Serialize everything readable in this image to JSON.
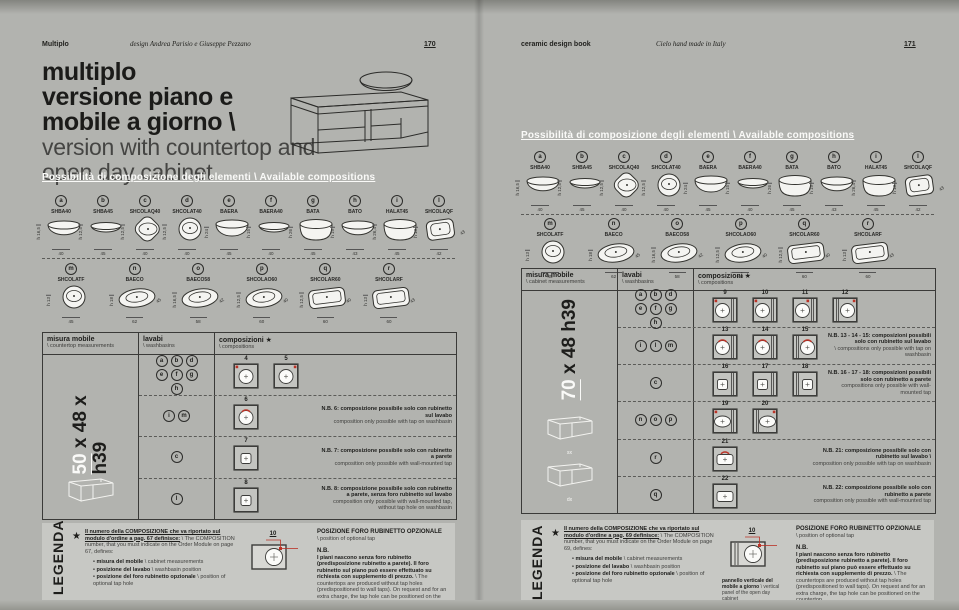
{
  "colors": {
    "page_bg": "#b2b3af",
    "legend_bg": "#c7c8c4",
    "ink": "#1d1d1b",
    "white": "#fafaf8",
    "red": "#bb3327",
    "tile_bg": "#c3c4c0"
  },
  "washbasins": {
    "row1": [
      {
        "letter": "a",
        "code": "SHBA40",
        "shape": "bowl",
        "h": "h 16,5",
        "w": "40"
      },
      {
        "letter": "b",
        "code": "SHBA45",
        "shape": "bowlflat",
        "h": "h 12,5",
        "w": "45"
      },
      {
        "letter": "c",
        "code": "SHCOLAQ40",
        "shape": "diamond",
        "h": "h 12,5",
        "w": "40"
      },
      {
        "letter": "d",
        "code": "SHCOLAT40",
        "shape": "round",
        "h": "h 12,5",
        "w": "40"
      },
      {
        "letter": "e",
        "code": "BAERA",
        "shape": "bowltall",
        "h": "h 24",
        "w": "45"
      },
      {
        "letter": "f",
        "code": "BAERA40",
        "shape": "bowlflat",
        "h": "h 15",
        "w": "40"
      },
      {
        "letter": "g",
        "code": "BATA",
        "shape": "cyl",
        "h": "h 26",
        "w": "45"
      },
      {
        "letter": "h",
        "code": "BATO",
        "shape": "bowl",
        "h": "h 19",
        "w": "43"
      },
      {
        "letter": "i",
        "code": "HALAT45",
        "shape": "cyl",
        "h": "h 26,4",
        "w": "45"
      },
      {
        "letter": "l",
        "code": "SHCOLAQF",
        "shape": "squareiso",
        "h": "h 13",
        "w": "42",
        "d": "43"
      }
    ],
    "row2": [
      {
        "letter": "m",
        "code": "SHCOLATF",
        "shape": "round",
        "h": "h 13",
        "w": "45"
      },
      {
        "letter": "n",
        "code": "BAECO",
        "shape": "ovaliso",
        "h": "h 18",
        "w": "62",
        "d": "45"
      },
      {
        "letter": "o",
        "code": "BAECO58",
        "shape": "ovaliso",
        "h": "h 16,5",
        "w": "58",
        "d": "42"
      },
      {
        "letter": "p",
        "code": "SHCOLAO60",
        "shape": "ovaliso",
        "h": "h 12,5",
        "w": "60",
        "d": "40"
      },
      {
        "letter": "q",
        "code": "SHCOLAR60",
        "shape": "rectiso",
        "h": "h 12,5",
        "w": "60",
        "d": "40"
      },
      {
        "letter": "r",
        "code": "SHCOLARF",
        "shape": "rectiso",
        "h": "h 13",
        "w": "60",
        "d": "43"
      }
    ]
  },
  "pages": {
    "left": {
      "header": {
        "brand": "Multiplo",
        "credit": "design Andrea Parisio e Giuseppe Pezzano",
        "page": "170"
      },
      "title_lines": [
        "multiplo",
        "versione piano e",
        "mobile a giorno \\"
      ],
      "subtitle_lines": [
        "version with countertop and",
        "open day cabinet"
      ],
      "section_heading": "Possibilità di composizione degli elementi \\ Available compositions",
      "table": {
        "h1_it": "misura mobile",
        "h1_en": "\\ countertop measurements",
        "h2_it": "lavabi",
        "h2_en": "\\ washbasins",
        "h3_it": "composizioni ★",
        "h3_en": "\\ compositions",
        "size_hi": "50",
        "size_rest": " x 48 x h39",
        "icon_labels": [
          ""
        ],
        "rows": [
          {
            "letters": [
              [
                "a",
                "b",
                "d"
              ],
              [
                "e",
                "f",
                "g"
              ],
              [
                "h"
              ]
            ],
            "comps": [
              {
                "n": "4",
                "basin": "circle",
                "mark": "tl"
              },
              {
                "n": "5",
                "basin": "circle",
                "mark": "tr"
              }
            ],
            "note_it": "",
            "note_en": ""
          },
          {
            "letters": [
              [
                "i",
                "m"
              ]
            ],
            "comps": [
              {
                "n": "6",
                "basin": "circle",
                "mark": "top"
              }
            ],
            "note_it": "N.B. 6: composizione possibile solo con rubinetto sul lavabo",
            "note_en": "composition only possible with tap on washbasin"
          },
          {
            "letters": [
              [
                "c"
              ]
            ],
            "comps": [
              {
                "n": "7",
                "basin": "square"
              }
            ],
            "note_it": "N.B. 7: composizione possibile solo con rubinetto a parete",
            "note_en": "composition only possible with wall-mounted tap"
          },
          {
            "letters": [
              [
                "l"
              ]
            ],
            "comps": [
              {
                "n": "8",
                "basin": "square"
              }
            ],
            "note_it": "N.B. 8: composizione possibile solo con rubinetto a parete, senza foro rubinetto sul lavabo",
            "note_en": "composition only possible with wall-mounted tap, without tap hole on washbasin"
          }
        ]
      },
      "legenda": {
        "rot": "LEGENDA",
        "star": "★",
        "intro_it": "Il numero della COMPOSIZIONE che va riportato sul modulo d'ordine a pag. 67 definisce:",
        "intro_en": "\\ The COMPOSITION number, that you must indicate on the Order Module on page 67, defines:",
        "bullets": [
          {
            "it": "misura del mobile",
            "en": "\\ cabinet measurements"
          },
          {
            "it": "posizione del lavabo",
            "en": "\\ washbasin position"
          },
          {
            "it": "posizione del foro rubinetto opzionale",
            "en": "\\ position of optional tap hole"
          }
        ],
        "dia_num": "10",
        "dia_caption_it": "",
        "dia_caption_en": "",
        "dia_panel": false,
        "pos_title": "POSIZIONE FORO RUBINETTO OPZIONALE",
        "pos_sub": "\\ position of optional tap",
        "nb_title": "N.B.",
        "nb_it": "I piani nascono senza foro rubinetto (predisposizione rubinetto a parete). Il foro rubinetto sul piano può essere effettuato su richiesta con supplemento di prezzo.",
        "nb_en": "\\ The countertops are produced without tap holes (predispositioned to wall taps). On request and for an extra charge, the tap hole can be positioned on the countertop."
      }
    },
    "right": {
      "header": {
        "brand": "ceramic design book",
        "credit": "Cielo hand made in Italy",
        "page": "171"
      },
      "section_heading": "Possibilità di composizione degli elementi \\ Available compositions",
      "table": {
        "h1_it": "misura mobile",
        "h1_en": "\\ cabinet measurements",
        "h2_it": "lavabi",
        "h2_en": "\\ washbasins",
        "h3_it": "composizioni ★",
        "h3_en": "\\ compositions",
        "size_hi": "70",
        "size_rest": " x 48 h39",
        "icon_labels": [
          "sx",
          "dx"
        ],
        "rows": [
          {
            "letters": [
              [
                "a",
                "b",
                "d"
              ],
              [
                "e",
                "f",
                "g"
              ],
              [
                "h"
              ]
            ],
            "comps": [
              {
                "n": "9",
                "basin": "circle",
                "mark": "tl",
                "panel": "right"
              },
              {
                "n": "10",
                "basin": "circle",
                "mark": "tl",
                "panel": "right"
              },
              {
                "n": "11",
                "basin": "circle",
                "mark": "tr",
                "panel": "right"
              },
              {
                "n": "12",
                "basin": "circle",
                "mark": "tr",
                "panel": "left"
              }
            ],
            "note_it": "",
            "note_en": ""
          },
          {
            "letters": [
              [
                "i",
                "l",
                "m"
              ]
            ],
            "comps": [
              {
                "n": "13",
                "basin": "circle",
                "mark": "top",
                "panel": "right"
              },
              {
                "n": "14",
                "basin": "circle",
                "mark": "top",
                "panel": "right"
              },
              {
                "n": "15",
                "basin": "circle",
                "mark": "top",
                "panel": "left"
              }
            ],
            "note_it": "N.B. 13 - 14 - 15: composizioni possibili solo con rubinetto sul lavabo",
            "note_en": "\\ compositions only possible with tap on washbasin"
          },
          {
            "letters": [
              [
                "c"
              ]
            ],
            "comps": [
              {
                "n": "16",
                "basin": "square",
                "panel": "right"
              },
              {
                "n": "17",
                "basin": "square",
                "panel": "right"
              },
              {
                "n": "18",
                "basin": "square",
                "panel": "left"
              }
            ],
            "note_it": "N.B. 16 - 17 - 18: composizioni possibili solo con rubinetto a parete",
            "note_en": "compositions only possible with wall-mounted tap"
          },
          {
            "letters": [
              [
                "n",
                "o",
                "p"
              ]
            ],
            "comps": [
              {
                "n": "19",
                "basin": "oval",
                "mark": "tl",
                "panel": "right"
              },
              {
                "n": "20",
                "basin": "oval",
                "mark": "tr",
                "panel": "left"
              }
            ],
            "note_it": "",
            "note_en": ""
          },
          {
            "letters": [
              [
                "r"
              ]
            ],
            "comps": [
              {
                "n": "21",
                "basin": "rect",
                "mark": "top"
              }
            ],
            "note_it": "N.B. 21: composizione possibile solo con rubinetto sul lavabo \\",
            "note_en": "composition only possible with tap on washbasin"
          },
          {
            "letters": [
              [
                "q"
              ]
            ],
            "comps": [
              {
                "n": "22",
                "basin": "rect"
              }
            ],
            "note_it": "N.B. 22: composizione possibile solo con rubinetto a parete",
            "note_en": "composition only possible with wall-mounted tap"
          }
        ]
      },
      "legenda": {
        "rot": "LEGENDA",
        "star": "★",
        "intro_it": "Il numero della COMPOSIZIONE che va riportato sul modulo d'ordine a pag. 69 definisce:",
        "intro_en": "\\ The COMPOSITION number, that you must indicate on the Order Module on page 69, defines:",
        "bullets": [
          {
            "it": "misura del mobile",
            "en": "\\ cabinet measurements"
          },
          {
            "it": "posizione del lavabo",
            "en": "\\ washbasin position"
          },
          {
            "it": "posizione del foro rubinetto opzionale",
            "en": "\\ position of optional tap hole"
          }
        ],
        "dia_num": "10",
        "dia_caption_it": "pannello verticale del mobile a giorno",
        "dia_caption_en": "\\ vertical panel of the open day cabinet",
        "dia_panel": true,
        "pos_title": "POSIZIONE FORO RUBINETTO OPZIONALE",
        "pos_sub": "\\ position of optional tap",
        "nb_title": "N.B.",
        "nb_it": "I piani nascono senza foro rubinetto (predisposizione rubinetto a parete). Il foro rubinetto sul piano può essere effettuato su richiesta con supplemento di prezzo.",
        "nb_en": "\\ The countertops are produced without tap holes (predispositioned to wall taps). On request and for an extra charge, the tap hole can be positioned on the countertop."
      }
    }
  }
}
